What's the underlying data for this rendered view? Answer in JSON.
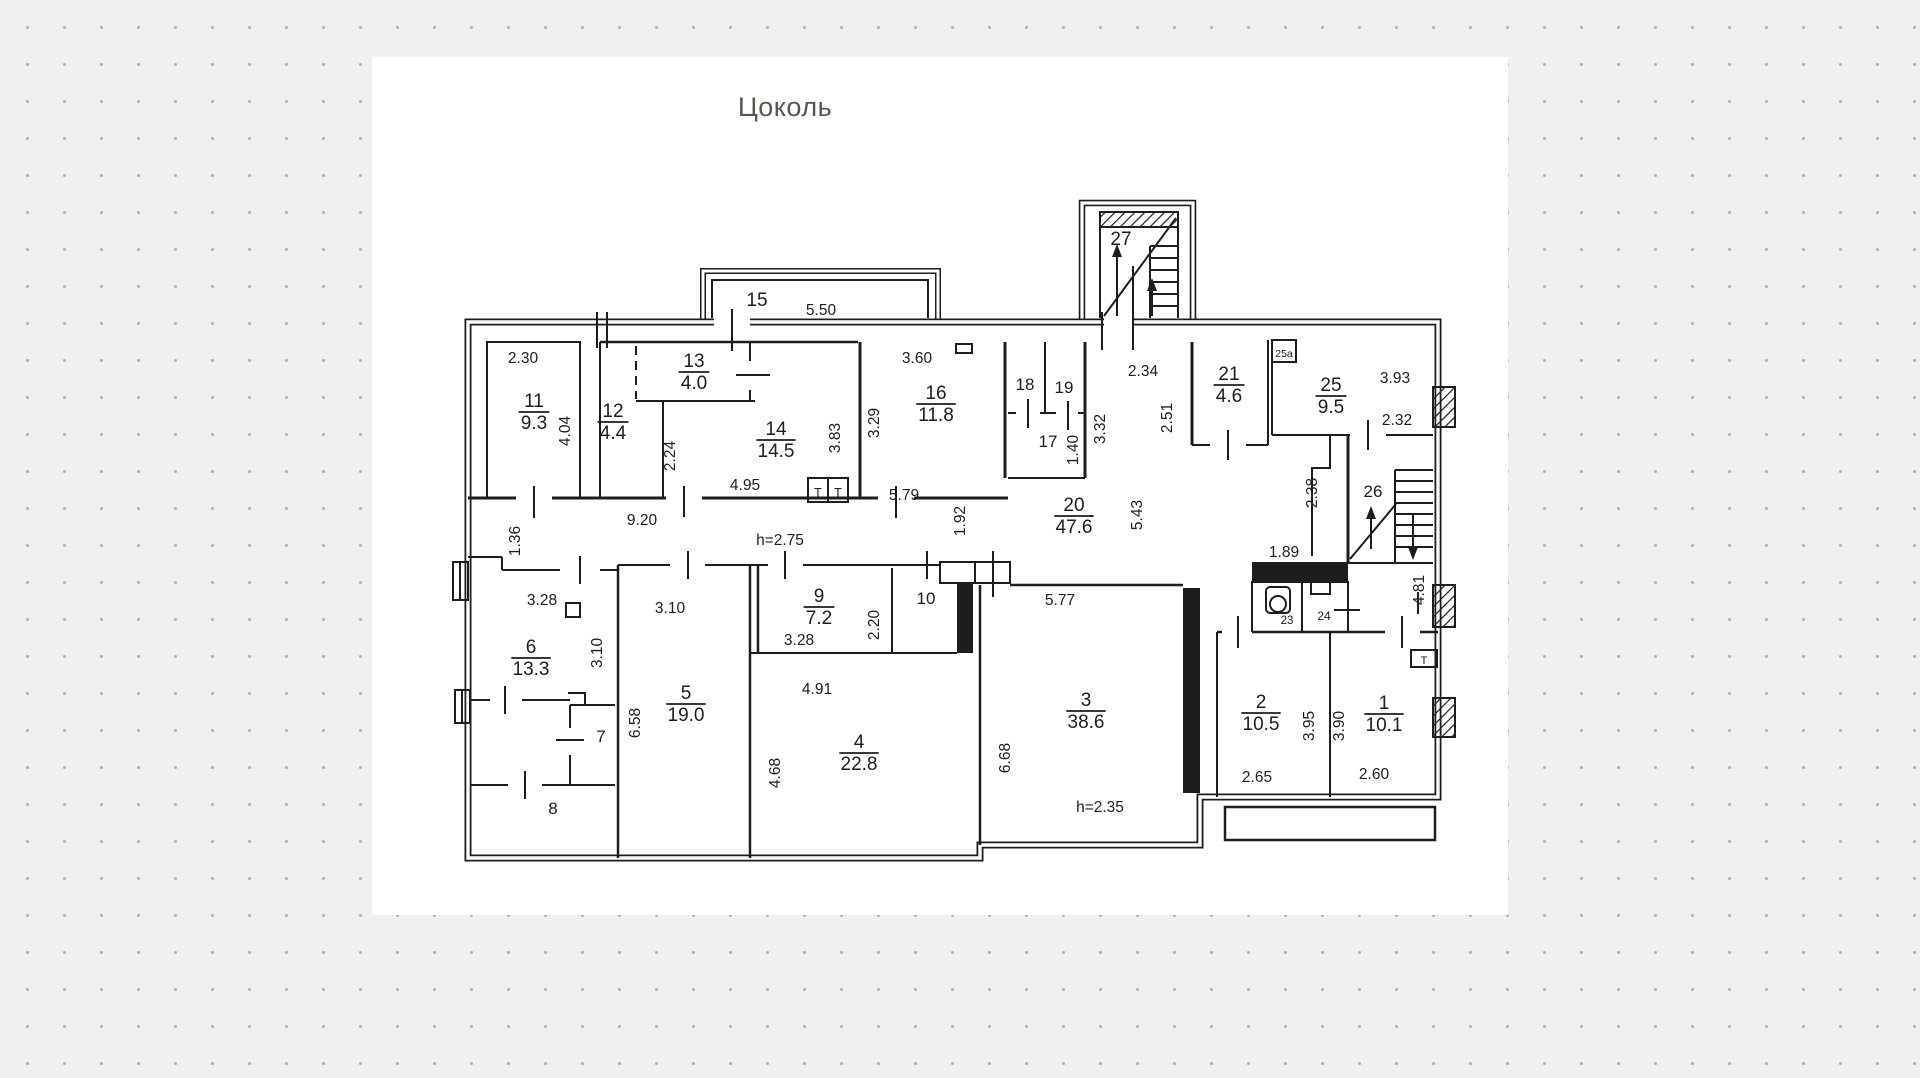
{
  "title": "Цоколь",
  "colors": {
    "background": "#f1f0ee",
    "dots": "#b5b3af",
    "paper": "#ffffff",
    "ink": "#1d1d1b",
    "dim_gray": "#8d8d8b"
  },
  "plan": {
    "rooms": [
      {
        "num": "11",
        "area": "9.3",
        "x": 534,
        "y": 412
      },
      {
        "num": "12",
        "area": "4.4",
        "x": 613,
        "y": 422
      },
      {
        "num": "13",
        "area": "4.0",
        "x": 694,
        "y": 372
      },
      {
        "num": "14",
        "area": "14.5",
        "x": 776,
        "y": 440
      },
      {
        "num": "16",
        "area": "11.8",
        "x": 936,
        "y": 404
      },
      {
        "num": "20",
        "area": "47.6",
        "x": 1074,
        "y": 516
      },
      {
        "num": "21",
        "area": "4.6",
        "x": 1229,
        "y": 385
      },
      {
        "num": "25",
        "area": "9.5",
        "x": 1331,
        "y": 396
      },
      {
        "num": "6",
        "area": "13.3",
        "x": 531,
        "y": 658
      },
      {
        "num": "5",
        "area": "19.0",
        "x": 686,
        "y": 704
      },
      {
        "num": "9",
        "area": "7.2",
        "x": 819,
        "y": 607
      },
      {
        "num": "4",
        "area": "22.8",
        "x": 859,
        "y": 753
      },
      {
        "num": "3",
        "area": "38.6",
        "x": 1086,
        "y": 711
      },
      {
        "num": "2",
        "area": "10.5",
        "x": 1261,
        "y": 713
      },
      {
        "num": "1",
        "area": "10.1",
        "x": 1384,
        "y": 714
      }
    ],
    "marks": [
      {
        "t": "15",
        "x": 757,
        "y": 306,
        "s": 19
      },
      {
        "t": "5.50",
        "x": 821,
        "y": 315
      },
      {
        "t": "27",
        "x": 1121,
        "y": 245,
        "s": 19
      },
      {
        "t": "18",
        "x": 1025,
        "y": 390,
        "s": 17
      },
      {
        "t": "19",
        "x": 1064,
        "y": 393,
        "s": 17
      },
      {
        "t": "17",
        "x": 1048,
        "y": 447,
        "s": 17
      },
      {
        "t": "10",
        "x": 926,
        "y": 604,
        "s": 17
      },
      {
        "t": "7",
        "x": 601,
        "y": 742,
        "s": 17
      },
      {
        "t": "8",
        "x": 553,
        "y": 814,
        "s": 17
      },
      {
        "t": "26",
        "x": 1373,
        "y": 497,
        "s": 17
      },
      {
        "t": "23",
        "x": 1287,
        "y": 624,
        "s": 11.5
      },
      {
        "t": "24",
        "x": 1324,
        "y": 620,
        "s": 12
      },
      {
        "t": "25а",
        "x": 1284,
        "y": 357,
        "s": 10.5
      },
      {
        "t": "Т",
        "x": 818,
        "y": 497,
        "s": 12.5
      },
      {
        "t": "Т",
        "x": 838,
        "y": 497,
        "s": 12.5
      },
      {
        "t": "Т",
        "x": 1424,
        "y": 664,
        "s": 11
      },
      {
        "t": "2.30",
        "x": 523,
        "y": 363
      },
      {
        "t": "4.04",
        "x": 570,
        "y": 431,
        "r": 1
      },
      {
        "t": "2.24",
        "x": 675,
        "y": 456,
        "r": 1
      },
      {
        "t": "3.83",
        "x": 840,
        "y": 438,
        "r": 1
      },
      {
        "t": "4.95",
        "x": 745,
        "y": 490
      },
      {
        "t": "9.20",
        "x": 642,
        "y": 525
      },
      {
        "t": "1.36",
        "x": 520,
        "y": 541,
        "r": 1
      },
      {
        "t": "3.60",
        "x": 917,
        "y": 363
      },
      {
        "t": "3.29",
        "x": 879,
        "y": 423,
        "r": 1
      },
      {
        "t": "5.79",
        "x": 904,
        "y": 500
      },
      {
        "t": "1.92",
        "x": 965,
        "y": 521,
        "r": 1
      },
      {
        "t": "h=2.75",
        "x": 780,
        "y": 545,
        "c": 1
      },
      {
        "t": "2.34",
        "x": 1143,
        "y": 376
      },
      {
        "t": "3.32",
        "x": 1105,
        "y": 429,
        "r": 1
      },
      {
        "t": "2.51",
        "x": 1172,
        "y": 418,
        "r": 1
      },
      {
        "t": "5.43",
        "x": 1142,
        "y": 515,
        "r": 1
      },
      {
        "t": "1.40",
        "x": 1078,
        "y": 450,
        "r": 1
      },
      {
        "t": "3.93",
        "x": 1395,
        "y": 383
      },
      {
        "t": "2.32",
        "x": 1397,
        "y": 425
      },
      {
        "t": "2.38",
        "x": 1317,
        "y": 493,
        "r": 1
      },
      {
        "t": "1.89",
        "x": 1284,
        "y": 557
      },
      {
        "t": "4.81",
        "x": 1424,
        "y": 590,
        "r": 1
      },
      {
        "t": "3.28",
        "x": 542,
        "y": 605
      },
      {
        "t": "3.10",
        "x": 602,
        "y": 653,
        "r": 1
      },
      {
        "t": "3.10",
        "x": 670,
        "y": 613
      },
      {
        "t": "6.58",
        "x": 640,
        "y": 723,
        "r": 1
      },
      {
        "t": "3.28",
        "x": 799,
        "y": 645
      },
      {
        "t": "2.20",
        "x": 879,
        "y": 625,
        "r": 1
      },
      {
        "t": "4.91",
        "x": 817,
        "y": 694
      },
      {
        "t": "4.68",
        "x": 780,
        "y": 773,
        "r": 1
      },
      {
        "t": "5.77",
        "x": 1060,
        "y": 605
      },
      {
        "t": "6.68",
        "x": 1010,
        "y": 758,
        "r": 1
      },
      {
        "t": "h=2.35",
        "x": 1100,
        "y": 812,
        "c": 1
      },
      {
        "t": "2.65",
        "x": 1257,
        "y": 782
      },
      {
        "t": "3.95",
        "x": 1314,
        "y": 726,
        "r": 1
      },
      {
        "t": "3.90",
        "x": 1344,
        "y": 726,
        "r": 1
      },
      {
        "t": "2.60",
        "x": 1374,
        "y": 779
      }
    ]
  }
}
